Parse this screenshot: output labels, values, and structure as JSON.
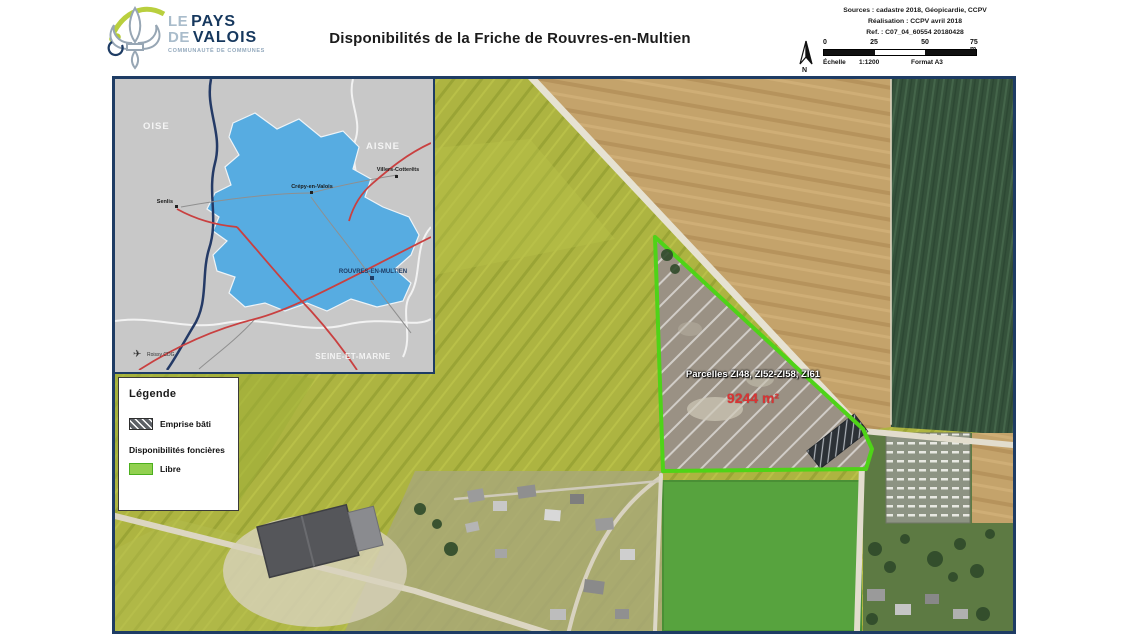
{
  "header": {
    "logo": {
      "top_light": "LE",
      "top_bold": "PAYS",
      "bottom_light": "DE",
      "bottom_bold": "VALOIS",
      "subtitle": "COMMUNAUTÉ DE COMMUNES"
    },
    "title": "Disponibilités de la Friche de Rouvres-en-Multien",
    "sources_lines": {
      "0": "Sources : cadastre 2018, Géopicardie, CCPV",
      "1": "Réalisation : CCPV avril 2018",
      "2": "Ref. : C07_04_60554 20180428"
    },
    "scalebar": {
      "north_label": "N",
      "ticks": {
        "0": "0",
        "1": "25",
        "2": "50",
        "3": "75 m"
      },
      "scale_label": "Échelle",
      "scale_value": "1:1200",
      "format": "Format A3"
    }
  },
  "inset_map": {
    "departments": {
      "0": "OISE",
      "1": "AISNE",
      "2": "SEINE-ET-MARNE"
    },
    "towns": {
      "0": "Senlis",
      "1": "Crépy-en-Valois",
      "2": "Villers-Cotterêts"
    },
    "highlighted_town": "ROUVRES-EN-MULTIEN",
    "airport_label": "Roissy CDG",
    "territory_color": "#57ace1"
  },
  "legend": {
    "title": "Légende",
    "built_label": "Emprise bâti",
    "section_label": "Disponibilités foncières",
    "free_label": "Libre",
    "free_color": "#92d050"
  },
  "main_map": {
    "parcel_label": "Parcelles ZI48, ZI52-ZI58, ZI61",
    "area_label": "9244 m²",
    "parcel_outline_color": "#4fd318",
    "area_text_color": "#d93434"
  },
  "frame_color": "#1e3c64"
}
